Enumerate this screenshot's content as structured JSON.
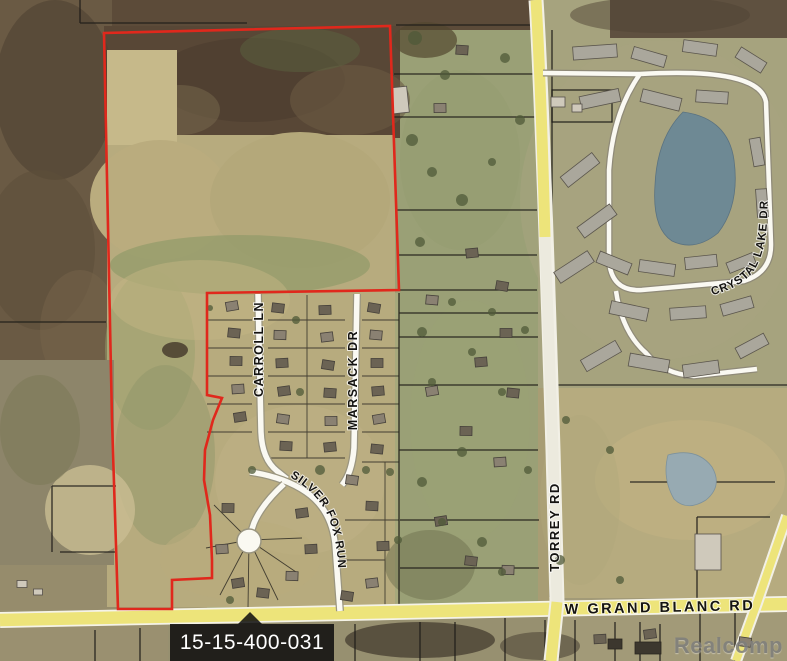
{
  "map": {
    "parcel": {
      "id_label": "15-15-400-031"
    },
    "watermark": "Realcomp",
    "roads": {
      "torrey": {
        "label": "TORREY RD"
      },
      "grand_blanc": {
        "label": "W GRAND BLANC RD"
      },
      "crystal_lake": {
        "label": "CRYSTAL LAKE DR"
      },
      "carroll": {
        "label": "CARROLL LN"
      },
      "marsack": {
        "label": "MARSACK DR"
      },
      "silver_fox": {
        "label": "SILVER FOX RUN"
      }
    },
    "colors": {
      "boundary": "#e0281c",
      "road_yellow": "#ede47a",
      "road_white": "#faf9f2",
      "parcel_line": "#1e1c18",
      "lake": "#6e8994",
      "pond": "#97aab2",
      "callout_bg": "rgba(12,12,12,0.85)",
      "callout_text": "#ffffff",
      "watermark_color": "#7e7e7c"
    }
  }
}
